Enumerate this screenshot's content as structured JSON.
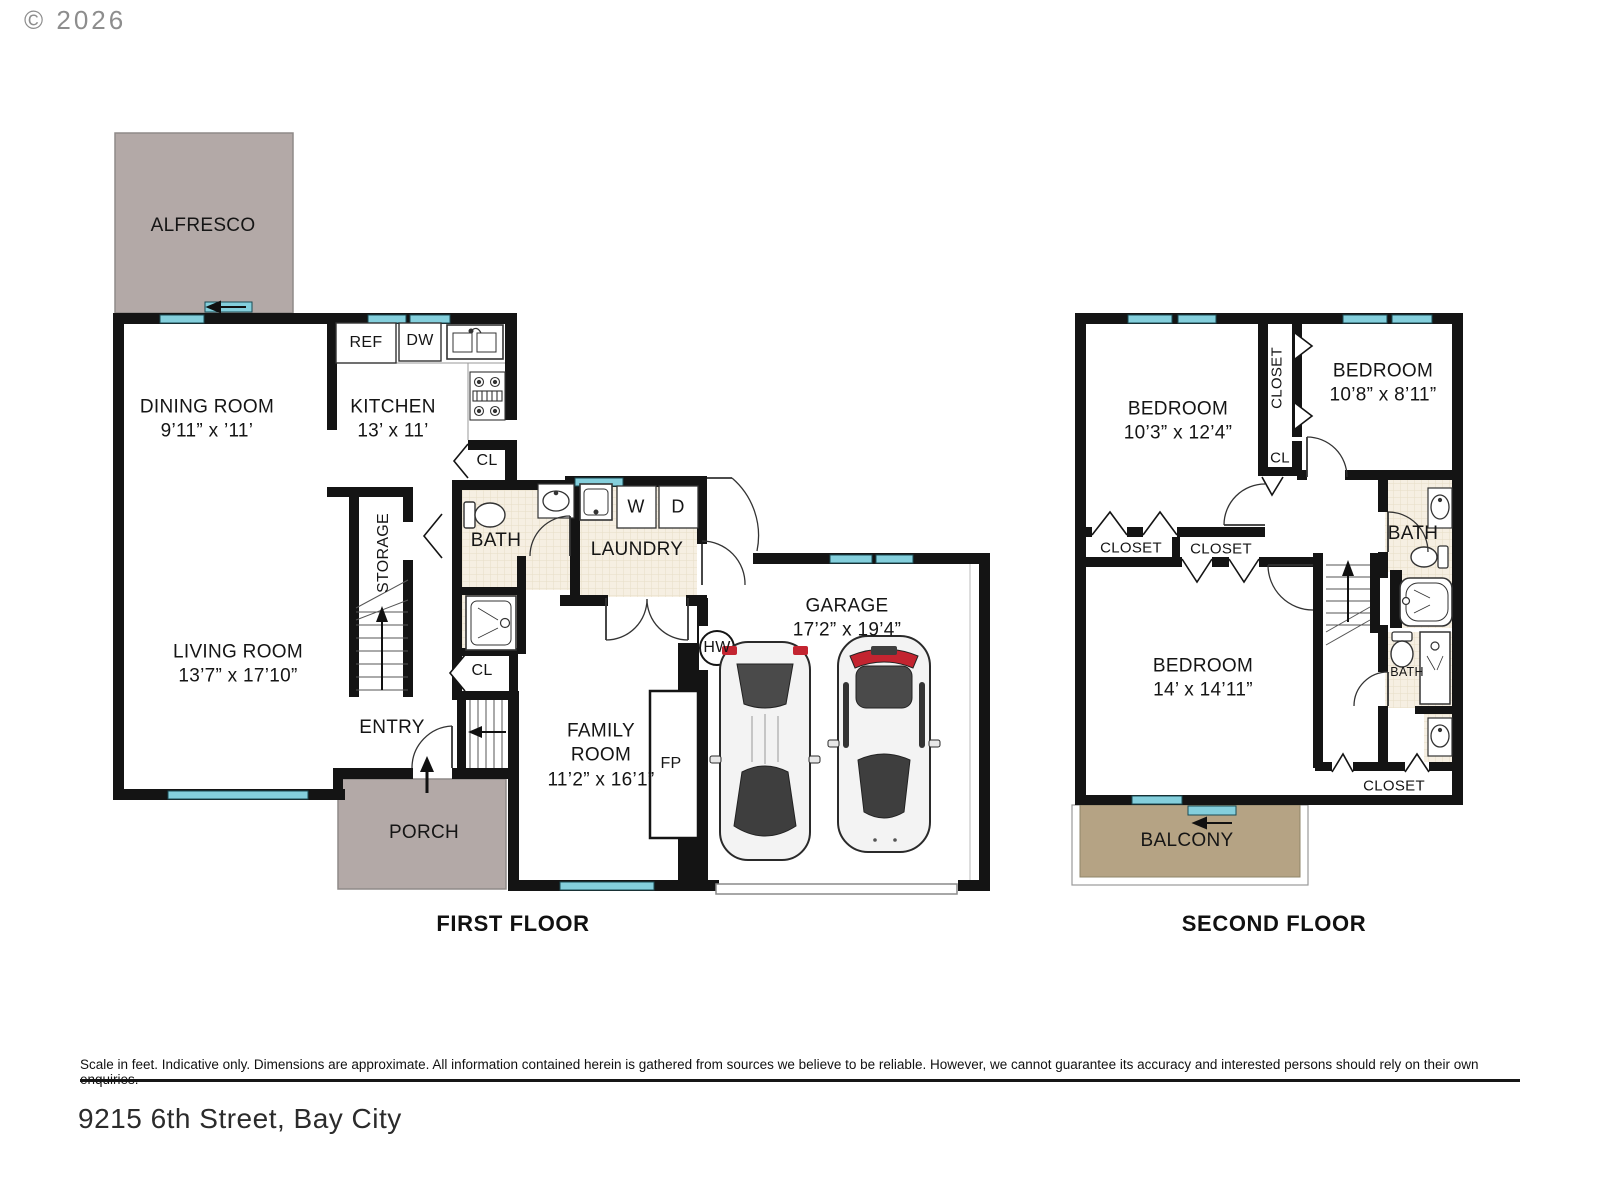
{
  "copyright": "© 2026",
  "footer": {
    "disclaimer": "Scale in feet. Indicative only. Dimensions are approximate. All information contained herein is gathered from sources we believe to be reliable. However, we cannot guarantee its accuracy and interested persons should rely on their own enquiries.",
    "address": "9215 6th Street, Bay City"
  },
  "colors": {
    "wall": "#141414",
    "window": "#84cfdc",
    "outdoor_gray": "#b3a9a7",
    "balcony_tan": "#b5a384",
    "bath_floor": "#f6efe2",
    "car_red": "#c32430"
  },
  "floor1": {
    "label": "FIRST FLOOR",
    "rooms": {
      "alfresco": {
        "name": "ALFRESCO"
      },
      "dining": {
        "name": "DINING ROOM",
        "dims": "9’11” x ’11’"
      },
      "kitchen": {
        "name": "KITCHEN",
        "dims": "13’ x 11’"
      },
      "living": {
        "name": "LIVING ROOM",
        "dims": "13’7” x 17’10”"
      },
      "family": {
        "name_line1": "FAMILY",
        "name_line2": "ROOM",
        "dims": "11’2” x 16’1”"
      },
      "garage": {
        "name": "GARAGE",
        "dims": "17’2” x 19’4”"
      },
      "bath": {
        "name": "BATH"
      },
      "laundry": {
        "name": "LAUNDRY"
      },
      "storage": {
        "name": "STORAGE"
      },
      "entry": {
        "name": "ENTRY"
      },
      "porch": {
        "name": "PORCH"
      }
    },
    "fixtures": {
      "ref": "REF",
      "dw": "DW",
      "washer": "W",
      "dryer": "D",
      "hot_water": "HW",
      "fireplace": "FP",
      "closet_kitchen": "CL",
      "closet_hall": "CL"
    }
  },
  "floor2": {
    "label": "SECOND FLOOR",
    "rooms": {
      "bedroom1": {
        "name": "BEDROOM",
        "dims": "10’3” x 12’4”"
      },
      "bedroom2": {
        "name": "BEDROOM",
        "dims": "10’8” x 8’11”"
      },
      "bedroom3": {
        "name": "BEDROOM",
        "dims": "14’ x 14’11”"
      },
      "bath_upper": {
        "name": "BATH"
      },
      "bath_lower": {
        "name": "BATH"
      },
      "closet_hall_vertical": {
        "name": "CLOSET"
      },
      "closet_left": {
        "name": "CLOSET"
      },
      "closet_mid": {
        "name": "CLOSET"
      },
      "closet_bottom": {
        "name": "CLOSET"
      },
      "closet_small": {
        "name": "CL"
      },
      "balcony": {
        "name": "BALCONY"
      }
    }
  }
}
